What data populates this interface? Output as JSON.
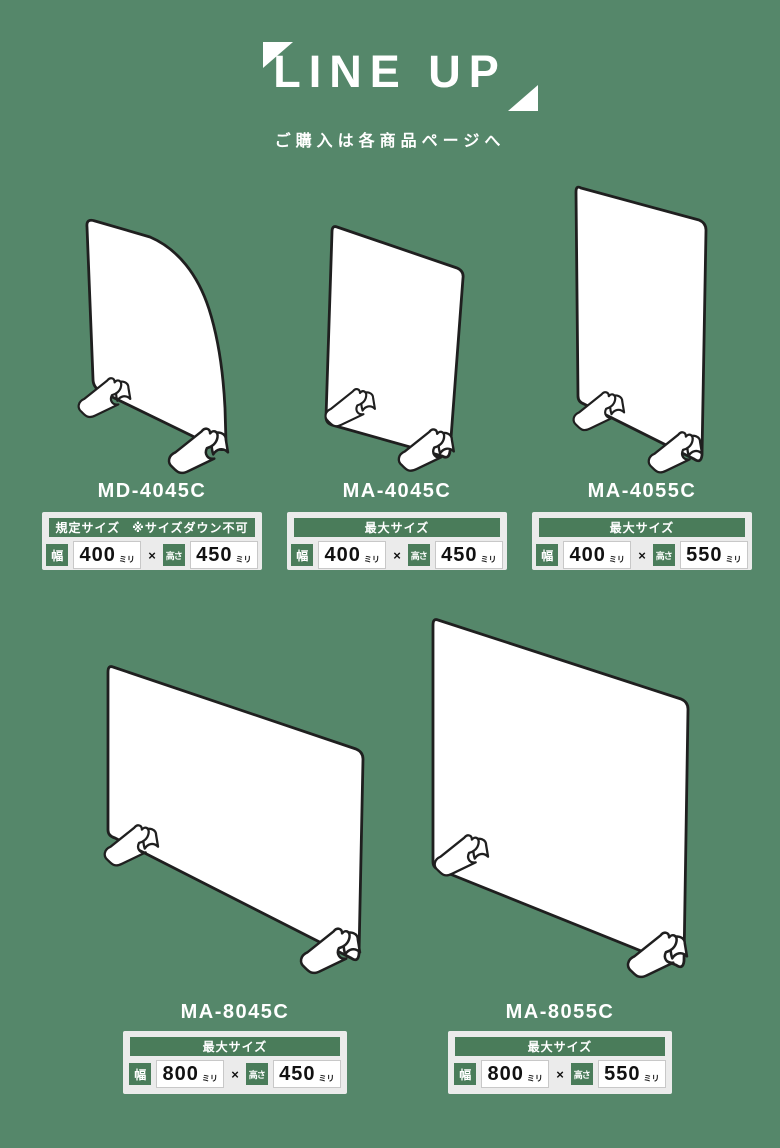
{
  "colors": {
    "background": "#55876A",
    "band_green": "#4A7C5A",
    "panel_outline": "#1F1F1F",
    "spec_box_bg": "#EBEBEB",
    "text_white": "#FFFFFF"
  },
  "header": {
    "title": "LINE UP",
    "subtitle": "ご購入は各商品ページへ"
  },
  "labels": {
    "width": "幅",
    "height": "高さ",
    "unit": "ミリ",
    "times": "×"
  },
  "products": [
    {
      "model": "MD-4045C",
      "size_type": "規定サイズ",
      "size_note": "※サイズダウン不可",
      "width": "400",
      "height": "450"
    },
    {
      "model": "MA-4045C",
      "size_type": "最大サイズ",
      "size_note": "",
      "width": "400",
      "height": "450"
    },
    {
      "model": "MA-4055C",
      "size_type": "最大サイズ",
      "size_note": "",
      "width": "400",
      "height": "550"
    },
    {
      "model": "MA-8045C",
      "size_type": "最大サイズ",
      "size_note": "",
      "width": "800",
      "height": "450"
    },
    {
      "model": "MA-8055C",
      "size_type": "最大サイズ",
      "size_note": "",
      "width": "800",
      "height": "550"
    }
  ]
}
